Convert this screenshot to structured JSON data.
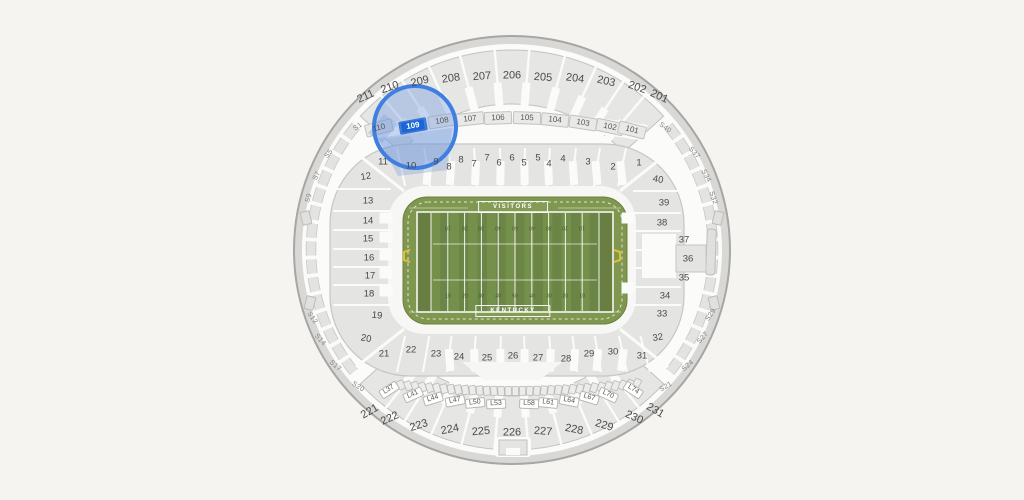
{
  "page": {
    "background": "#f5f4f1"
  },
  "map": {
    "selected_section": "109",
    "upper_north": [
      "211",
      "210",
      "209",
      "208",
      "207",
      "206",
      "205",
      "204",
      "203",
      "202",
      "201"
    ],
    "club_north": [
      "110",
      "109",
      "108",
      "107",
      "106",
      "105",
      "104",
      "103",
      "102",
      "101"
    ],
    "lower_north": [
      "11",
      "10",
      "9",
      "8",
      "8",
      "7",
      "7",
      "6",
      "6",
      "5",
      "5",
      "4",
      "4",
      "3",
      "2",
      "1"
    ],
    "lower_west": [
      "12",
      "13",
      "14",
      "15",
      "16",
      "17",
      "18",
      "19"
    ],
    "lower_south": [
      "20",
      "21",
      "22",
      "23",
      "24",
      "25",
      "26",
      "27",
      "28",
      "29",
      "30",
      "31"
    ],
    "lower_east": [
      "40",
      "39",
      "38",
      "37",
      "36",
      "35",
      "34",
      "33",
      "32"
    ],
    "loge_south": [
      "L37",
      "L41",
      "L44",
      "L47",
      "L50",
      "L53",
      "L58",
      "L61",
      "L64",
      "L67",
      "L70",
      "L74"
    ],
    "upper_south": [
      "221",
      "222",
      "223",
      "224",
      "225",
      "226",
      "227",
      "228",
      "229",
      "230",
      "231"
    ],
    "suites_west": [
      "S1",
      "S5",
      "S7",
      "S9",
      "S12",
      "S14",
      "S17",
      "S20"
    ],
    "suites_east": [
      "S40",
      "S37",
      "S34",
      "S32",
      "S29",
      "S27",
      "S24",
      "S21"
    ],
    "field": {
      "top_label": "VISITORS",
      "bottom_label": "KENTUCKY",
      "yard_numbers": [
        "10",
        "20",
        "30",
        "40",
        "50",
        "40",
        "30",
        "20",
        "10"
      ]
    },
    "colors": {
      "selected": "#1a66d9",
      "highlight_ring": "#3f7fe0",
      "highlight_fill": "rgba(125,160,225,0.42)",
      "field_green": "#7f974e",
      "stripe_light": "#75904a",
      "stripe_dark": "#6a8545",
      "endzone_green": "#697f42",
      "seat_gray": "#e6e6e4",
      "outline_gray": "#c2c2c0",
      "goalpost_yellow": "#e2bd3a"
    }
  }
}
